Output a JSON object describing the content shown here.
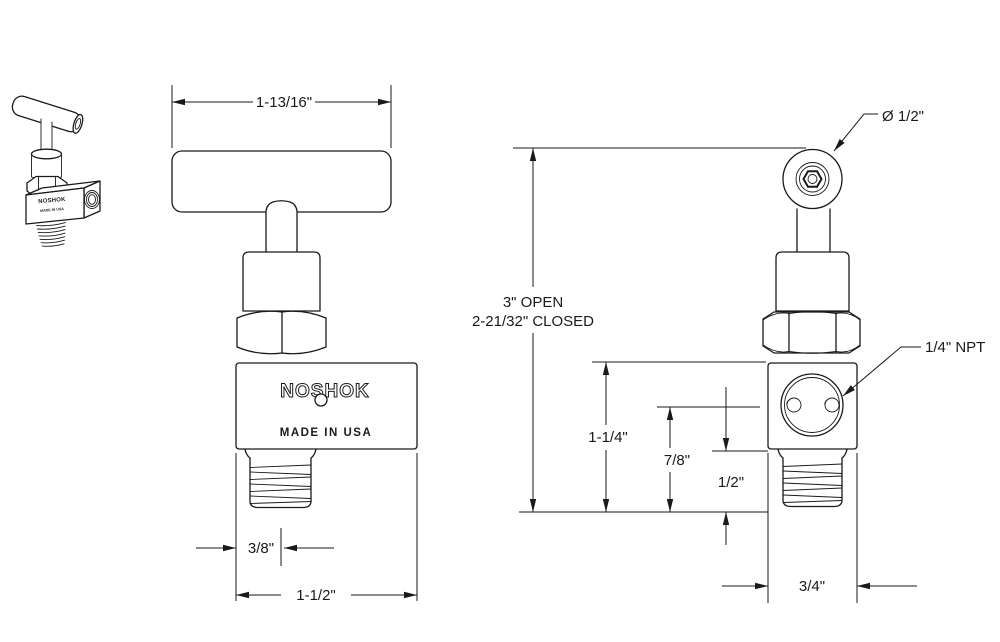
{
  "front_view": {
    "width_label": "1-13/16\"",
    "port_offset_label": "3/8\"",
    "body_width_label": "1-1/2\"",
    "brand": "NOSHOK",
    "origin": "MADE IN USA"
  },
  "side_view": {
    "handle_dia_label": "Ø 1/2\"",
    "open_height_label": "3\" OPEN",
    "closed_height_label": "2-21/32\" CLOSED",
    "body_top_label": "1-1/4\"",
    "port_center_label": "7/8\"",
    "body_bottom_label": "1/2\"",
    "port_label": "1/4\" NPT",
    "depth_label": "3/4\""
  },
  "thumbnail": {
    "brand": "NOSHOK",
    "origin": "MADE IN USA"
  },
  "colors": {
    "line": "#1a1a1a",
    "background": "#ffffff"
  }
}
